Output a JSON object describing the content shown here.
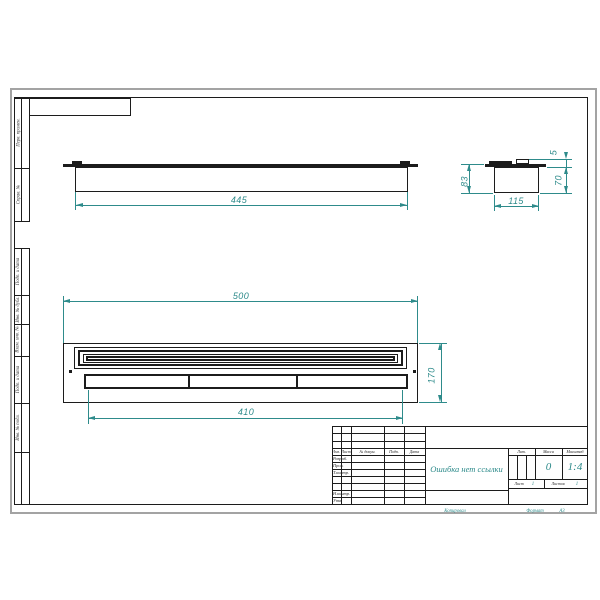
{
  "colors": {
    "accent": "#2e8b8b",
    "line": "#1c1c1c",
    "paper_edge": "#a3a3a3",
    "label": "#3a3a3a"
  },
  "stamps": {
    "left_column": [
      {
        "label": "Перв. примен."
      },
      {
        "label": "Справ. №"
      },
      {
        "label": "Подп. и дата"
      },
      {
        "label": "Инв. № дубл."
      },
      {
        "label": "Взам. инв. №"
      },
      {
        "label": "Подп. и дата"
      },
      {
        "label": "Инв. № подл."
      }
    ]
  },
  "views": {
    "top": {
      "width": "445"
    },
    "front": {
      "width": "500",
      "inner_width": "410",
      "height": "170"
    },
    "side": {
      "height": "83",
      "tab_height": "5",
      "body_height": "70",
      "width": "115"
    }
  },
  "title_block": {
    "change_header": [
      "Изм.",
      "Лист",
      "№ докум.",
      "Подп.",
      "Дата"
    ],
    "signature_rows": [
      "Разраб.",
      "Пров.",
      "Т.контр.",
      "Н.контр.",
      "Утв."
    ],
    "name": "Ошибка нет ссылки",
    "lit_label": "Лит.",
    "mass_label": "Масса",
    "scale_label": "Масштаб",
    "mass_value": "0",
    "scale_value": "1:4",
    "sheet_label": "Лист",
    "sheet_value": "1",
    "sheets_label": "Листов",
    "sheets_value": "1",
    "copy_label": "Копировал",
    "format_label": "Формат",
    "format_value": "А3"
  }
}
